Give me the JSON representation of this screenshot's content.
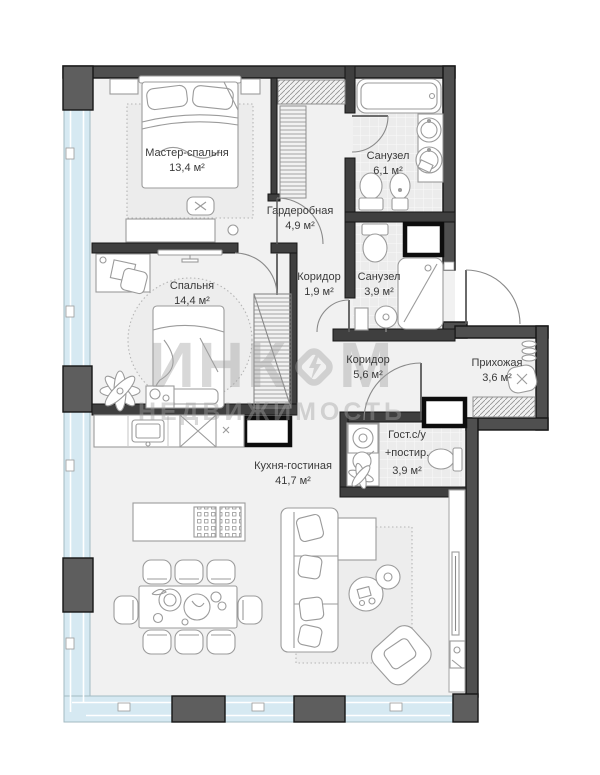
{
  "plan_title": "Apartment floor plan",
  "rooms": [
    {
      "name": "Мастер-спальня",
      "area": "13,4 м²"
    },
    {
      "name": "Гардеробная",
      "area": "4,9 м²"
    },
    {
      "name": "Санузел",
      "area": "6,1 м²"
    },
    {
      "name": "Коридор",
      "area": "1,9 м²"
    },
    {
      "name": "Санузел",
      "area": "3,9 м²"
    },
    {
      "name": "Спальня",
      "area": "14,4 м²"
    },
    {
      "name": "Коридор",
      "area": "5,6 м²"
    },
    {
      "name": "Прихожая",
      "area": "3,6 м²"
    },
    {
      "name": "Гост.с/у",
      "name2": "+постир.",
      "area": "3,9 м²"
    },
    {
      "name": "Кухня-гостиная",
      "area": "41,7 м²"
    }
  ],
  "watermark": {
    "brand_left": "ИНК",
    "brand_right": "М",
    "subtitle": "НЕДВИЖИМОСТЬ"
  },
  "colors": {
    "wall": "#4f4f4f",
    "inner_wall": "#3f3f3f",
    "column_block": "#5e5e5e",
    "floor": "#f1f1f1",
    "tile_floor": "#ececec",
    "glazing_blue": "#d6e9f2",
    "furniture_outline": "#9b9b9b",
    "label_text": "#3a3a3a",
    "watermark_gray": "#c6c6c6"
  }
}
